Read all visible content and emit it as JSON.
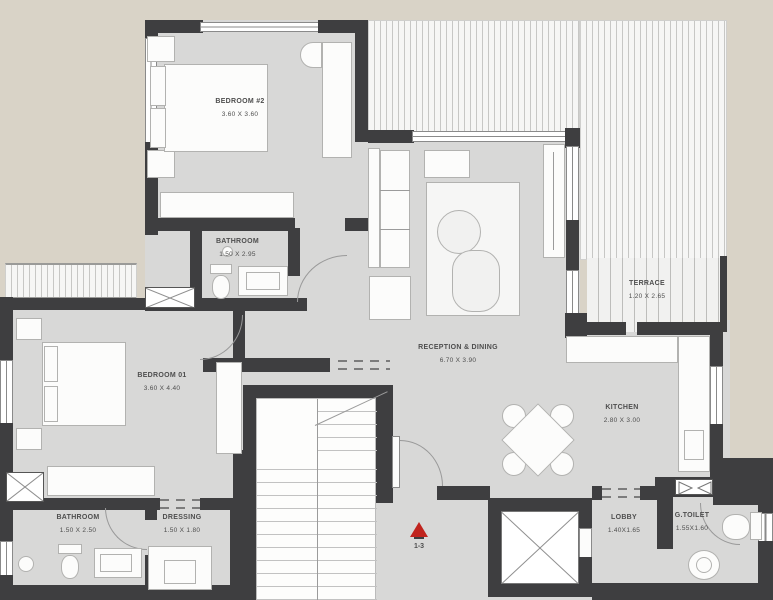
{
  "plan_title": "apartment-floor-plan",
  "rooms": [
    {
      "id": "bedroom-2",
      "name": "BEDROOM #2",
      "dims": "3.60 X 3.60"
    },
    {
      "id": "bathroom-upper",
      "name": "BATHROOM",
      "dims": "1.50 X 2.95"
    },
    {
      "id": "bedroom-1",
      "name": "BEDROOM 01",
      "dims": "3.60 X 4.40"
    },
    {
      "id": "reception-dining",
      "name": "RECEPTION & DINING",
      "dims": "6.70 X 3.90"
    },
    {
      "id": "terrace",
      "name": "TERRACE",
      "dims": "1.20 X 2.65"
    },
    {
      "id": "kitchen",
      "name": "KITCHEN",
      "dims": "2.80 X 3.00"
    },
    {
      "id": "bathroom-lower",
      "name": "BATHROOM",
      "dims": "1.50 X 2.50"
    },
    {
      "id": "dressing",
      "name": "DRESSING",
      "dims": "1.50 X 1.80"
    },
    {
      "id": "lobby",
      "name": "LOBBY",
      "dims": "1.40X1.65"
    },
    {
      "id": "g-toilet",
      "name": "G.TOILET",
      "dims": "1.55X1.60"
    }
  ],
  "section_marker": {
    "label": "1-3"
  },
  "colors": {
    "background": "#d9d3c7",
    "floor": "#d8d8d7",
    "wall": "#3e3e40",
    "furniture": "#fcfcfb",
    "marker_red": "#c0241e"
  }
}
